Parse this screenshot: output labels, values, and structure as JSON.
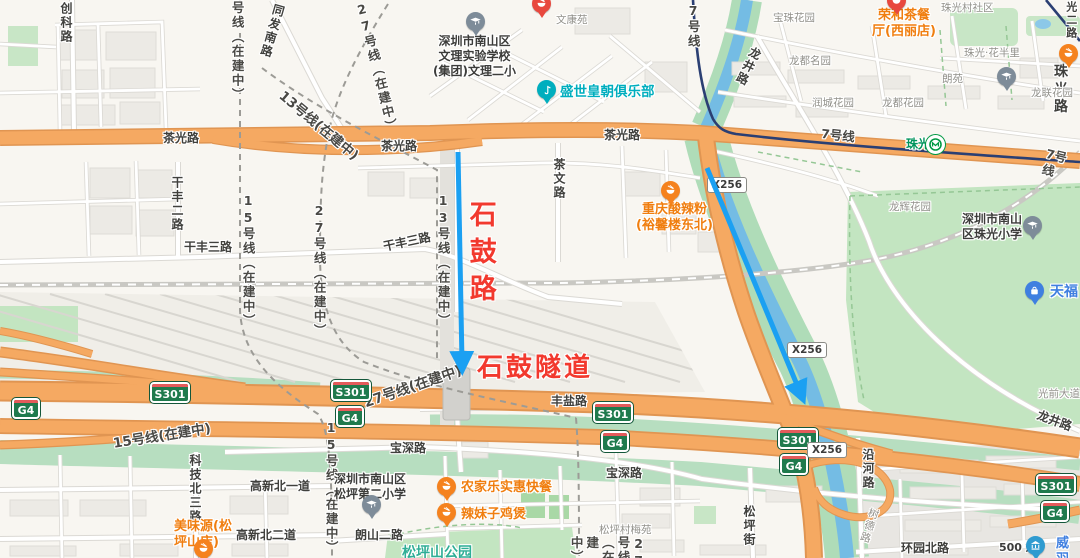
{
  "map": {
    "colors": {
      "background": "#F8F6F1",
      "orange_road": "#F5A962",
      "park_green": "#C3E5C1",
      "river_blue": "#74BCE4",
      "metro_navy": "#2B3F73",
      "badge_green": "#1F7A4D",
      "poi_orange": "#F07E0F",
      "annotation_red": "#F2392E",
      "arrow_blue": "#1BA0F2",
      "railway_gray": "#C9C8C3"
    },
    "scale_text": "500 米",
    "labels": [
      {
        "n": "road-chuangke-lu",
        "t": "创科路",
        "x": 58,
        "y": 2,
        "c": "rd",
        "v": 1,
        "i": false
      },
      {
        "n": "road-tongfa-nanlu",
        "t": "同发南路",
        "x": 272,
        "y": 2,
        "c": "rd",
        "v": 1,
        "r": 16,
        "i": false
      },
      {
        "n": "road-chaguang-lu-1",
        "t": "茶光路",
        "x": 163,
        "y": 131,
        "c": "rd",
        "i": false
      },
      {
        "n": "road-chaguang-lu-2",
        "t": "茶光路",
        "x": 381,
        "y": 139,
        "c": "rd",
        "i": false
      },
      {
        "n": "road-chaguang-lu-3",
        "t": "茶光路",
        "x": 604,
        "y": 128,
        "c": "rd",
        "i": false
      },
      {
        "n": "road-ganfeng-erlu",
        "t": "干丰二路",
        "x": 169,
        "y": 176,
        "c": "rd",
        "v": 1,
        "i": false
      },
      {
        "n": "road-ganfeng-sanlu-1",
        "t": "干丰三路",
        "x": 184,
        "y": 240,
        "c": "rd",
        "i": false
      },
      {
        "n": "road-ganfeng-sanlu-2",
        "t": "干丰三路",
        "x": 382,
        "y": 240,
        "c": "rd",
        "r": -12,
        "i": false
      },
      {
        "n": "road-chawen-lu",
        "t": "茶文路",
        "x": 551,
        "y": 158,
        "c": "rd",
        "v": 1,
        "i": false
      },
      {
        "n": "road-fengyan-lu",
        "t": "丰盐路",
        "x": 551,
        "y": 394,
        "c": "rd",
        "i": false
      },
      {
        "n": "road-baoshen-lu-1",
        "t": "宝深路",
        "x": 390,
        "y": 441,
        "c": "rd",
        "i": false
      },
      {
        "n": "road-baoshen-lu-2",
        "t": "宝深路",
        "x": 606,
        "y": 466,
        "c": "rd",
        "i": false
      },
      {
        "n": "road-gaoxin-beiyidao",
        "t": "高新北一道",
        "x": 250,
        "y": 479,
        "c": "rd",
        "i": false
      },
      {
        "n": "road-gaoxin-beierdao",
        "t": "高新北二道",
        "x": 236,
        "y": 528,
        "c": "rd",
        "i": false
      },
      {
        "n": "road-kejibei-sanlu",
        "t": "科技北三路",
        "x": 187,
        "y": 454,
        "c": "rd",
        "v": 1,
        "i": false
      },
      {
        "n": "road-langshan-erlu",
        "t": "朗山二路",
        "x": 355,
        "y": 528,
        "c": "rd",
        "i": false
      },
      {
        "n": "road-songping-jie",
        "t": "松坪街",
        "x": 741,
        "y": 505,
        "c": "rd",
        "v": 1,
        "i": false
      },
      {
        "n": "road-yanhe-lu",
        "t": "沿河路",
        "x": 860,
        "y": 448,
        "c": "rd",
        "v": 1,
        "i": false
      },
      {
        "n": "road-huanyuan-beilu",
        "t": "环园北路",
        "x": 901,
        "y": 541,
        "c": "rd",
        "i": false
      },
      {
        "n": "road-longjing-lu-1",
        "t": "龙井路",
        "x": 750,
        "y": 44,
        "c": "rd",
        "v": 1,
        "r": 26,
        "i": false
      },
      {
        "n": "road-longjing-lu-2",
        "t": "龙井路",
        "x": 1040,
        "y": 408,
        "c": "rd",
        "r": 20,
        "i": false
      },
      {
        "n": "road-zhuguang-lu",
        "t": "珠光路",
        "x": 1054,
        "y": 64,
        "c": "rd",
        "fs": 14,
        "i": false
      },
      {
        "n": "road-guang-er-lu",
        "t": "光二路",
        "x": 1064,
        "y": 1,
        "c": "rd",
        "v": 1,
        "fs": 11,
        "i": false
      },
      {
        "n": "road-guangqian-dadao",
        "t": "光前大道",
        "x": 1038,
        "y": 388,
        "c": "sm",
        "i": false
      },
      {
        "n": "road-shude-lu",
        "t": "树德路",
        "x": 868,
        "y": 506,
        "c": "sm",
        "v": 1,
        "r": 18,
        "i": false
      },
      {
        "n": "metro-15-top",
        "t": "号线（在建中）",
        "x": 229,
        "y": 1,
        "c": "met",
        "v": 1,
        "i": false
      },
      {
        "n": "metro-15-mid",
        "t": "15号线（在建中）",
        "x": 240,
        "y": 193,
        "c": "met",
        "v": 1,
        "i": false
      },
      {
        "n": "metro-27-mid",
        "t": "27号线（在建中）",
        "x": 311,
        "y": 203,
        "c": "met",
        "v": 1,
        "i": false
      },
      {
        "n": "metro-27-top",
        "t": "27号线（在建中）",
        "x": 352,
        "y": 4,
        "c": "met",
        "v": 1,
        "r": -14,
        "i": false
      },
      {
        "n": "metro-13-diag",
        "t": "13号线(在建中)",
        "x": 286,
        "y": 88,
        "c": "met",
        "r": 40,
        "fs": 13.5,
        "i": false
      },
      {
        "n": "metro-13-mid",
        "t": "13号线（在建中）",
        "x": 435,
        "y": 193,
        "c": "met",
        "v": 1,
        "i": false
      },
      {
        "n": "metro-15-diag",
        "t": "15号线(在建中)",
        "x": 112,
        "y": 436,
        "c": "met",
        "r": -9,
        "fs": 13.5,
        "i": false
      },
      {
        "n": "metro-15-low",
        "t": "15号线（在建中）",
        "x": 323,
        "y": 420,
        "c": "met",
        "v": 1,
        "i": false
      },
      {
        "n": "metro-27-diag",
        "t": "27号线(在建中)",
        "x": 362,
        "y": 396,
        "c": "met",
        "r": -19,
        "fs": 14,
        "i": false
      },
      {
        "n": "metro-27-low",
        "t": "27号线（在建中）",
        "x": 568,
        "y": 536,
        "c": "met",
        "v": 1,
        "i": false
      },
      {
        "n": "metro-7-top",
        "t": "7号线",
        "x": 685,
        "y": 3,
        "c": "met",
        "v": 1,
        "i": false
      },
      {
        "n": "metro-7-mid",
        "t": "7号线",
        "x": 822,
        "y": 126,
        "c": "met",
        "r": 6,
        "i": false
      },
      {
        "n": "metro-7-right",
        "t": "7号线",
        "x": 1048,
        "y": 146,
        "c": "met",
        "r": 14,
        "i": false
      },
      {
        "n": "estate-wenkangyuan",
        "t": "文康苑",
        "x": 556,
        "y": 14,
        "c": "sm",
        "i": false
      },
      {
        "n": "estate-baozhu-huayuan",
        "t": "宝珠花园",
        "x": 773,
        "y": 12,
        "c": "sm",
        "i": false
      },
      {
        "n": "estate-zhuguangcun-shequ",
        "t": "珠光村社区",
        "x": 941,
        "y": 2,
        "c": "sm",
        "i": false
      },
      {
        "n": "estate-zhuguang-huabanli",
        "t": "珠光·花半里",
        "x": 964,
        "y": 47,
        "c": "sm",
        "i": false
      },
      {
        "n": "estate-langyuan",
        "t": "朗苑",
        "x": 942,
        "y": 73,
        "c": "sm",
        "i": false
      },
      {
        "n": "estate-longdu-mingyuan",
        "t": "龙都名园",
        "x": 789,
        "y": 55,
        "c": "sm",
        "i": false
      },
      {
        "n": "estate-runcheng-huayuan",
        "t": "润城花园",
        "x": 812,
        "y": 97,
        "c": "sm",
        "i": false
      },
      {
        "n": "estate-longdu-huayuan",
        "t": "龙都花园",
        "x": 882,
        "y": 97,
        "c": "sm",
        "i": false
      },
      {
        "n": "estate-longlian-huayuan",
        "t": "龙联花园",
        "x": 1031,
        "y": 87,
        "c": "sm",
        "i": false
      },
      {
        "n": "estate-longhui-huayuan",
        "t": "龙辉花园",
        "x": 889,
        "y": 201,
        "c": "sm",
        "i": false
      },
      {
        "n": "estate-songpingcun-meiyuan",
        "t": "松坪村梅苑",
        "x": 599,
        "y": 524,
        "c": "sm",
        "i": false
      },
      {
        "n": "poi-ronghe-restaurant",
        "t": "荣和茶餐\n厅(西丽店)",
        "x": 872,
        "y": 8,
        "c": "org",
        "ctr": 1,
        "i": true
      },
      {
        "n": "poi-chongqing-suanlafen",
        "t": "重庆酸辣粉\n(裕馨楼东北)",
        "x": 636,
        "y": 202,
        "c": "org",
        "ctr": 1,
        "i": true
      },
      {
        "n": "poi-meiweiyuan",
        "t": "美味源(松\n坪山店)",
        "x": 174,
        "y": 519,
        "c": "org",
        "i": true
      },
      {
        "n": "poi-nongjiale",
        "t": "农家乐实惠快餐",
        "x": 461,
        "y": 480,
        "c": "org",
        "i": true
      },
      {
        "n": "poi-lameizi-jibao",
        "t": "辣妹子鸡煲",
        "x": 461,
        "y": 507,
        "c": "org",
        "i": true
      },
      {
        "n": "poi-shengshi-huangchao-club",
        "t": "盛世皇朝俱乐部",
        "x": 560,
        "y": 84,
        "c": "teal",
        "i": true
      },
      {
        "n": "poi-tianfu",
        "t": "天福",
        "x": 1050,
        "y": 284,
        "c": "blue",
        "fs": 14,
        "i": true
      },
      {
        "n": "poi-wei-clipped",
        "t": "威\n羽",
        "x": 1056,
        "y": 536,
        "c": "blue",
        "i": true
      },
      {
        "n": "metro-station-zhuguang",
        "t": "珠光",
        "x": 906,
        "y": 137,
        "c": "stn",
        "i": true
      },
      {
        "n": "park-songpingshan",
        "t": "松坪山公园",
        "x": 402,
        "y": 545,
        "c": "pk",
        "i": false
      },
      {
        "n": "school-wenli-exp",
        "t": "深圳市南山区\n文理实验学校\n(集团)文理二小",
        "x": 433,
        "y": 34,
        "c": "dk",
        "ctr": 1,
        "i": false
      },
      {
        "n": "school-zhuguang-primary",
        "t": "深圳市南山\n区珠光小学",
        "x": 962,
        "y": 212,
        "c": "dk",
        "ctr": 1,
        "i": false
      },
      {
        "n": "school-songping-no2",
        "t": "深圳市南山区\n松坪第二小学",
        "x": 334,
        "y": 472,
        "c": "dk",
        "ctr": 1,
        "i": false
      },
      {
        "n": "annotation-shigu-road",
        "t": "石鼓路",
        "x": 463,
        "y": 200,
        "c": "annv",
        "v": 1,
        "i": false
      },
      {
        "n": "annotation-shigu-tunnel",
        "t": "石鼓隧道",
        "x": 477,
        "y": 352,
        "c": "annh",
        "i": false
      },
      {
        "n": "scale-text",
        "t": "500 米",
        "x": 999,
        "y": 541,
        "c": "scale",
        "i": false
      }
    ],
    "badges": [
      {
        "k": "s301",
        "t": "S301",
        "x": 150,
        "y": 382
      },
      {
        "k": "s301",
        "t": "S301",
        "x": 331,
        "y": 380
      },
      {
        "k": "s301",
        "t": "S301",
        "x": 593,
        "y": 402
      },
      {
        "k": "s301",
        "t": "S301",
        "x": 778,
        "y": 428
      },
      {
        "k": "s301",
        "t": "S301",
        "x": 1036,
        "y": 474
      },
      {
        "k": "g4",
        "t": "G4",
        "x": 12,
        "y": 398
      },
      {
        "k": "g4",
        "t": "G4",
        "x": 336,
        "y": 406
      },
      {
        "k": "g4",
        "t": "G4",
        "x": 601,
        "y": 431
      },
      {
        "k": "g4",
        "t": "G4",
        "x": 780,
        "y": 454
      },
      {
        "k": "g4",
        "t": "G4",
        "x": 1041,
        "y": 501
      },
      {
        "k": "x256",
        "t": "X256",
        "x": 707,
        "y": 177
      },
      {
        "k": "x256",
        "t": "X256",
        "x": 787,
        "y": 342
      },
      {
        "k": "x256",
        "t": "X256",
        "x": 807,
        "y": 442
      }
    ],
    "pois": [
      {
        "n": "school-pin-wenli",
        "k": "cap",
        "x": 476,
        "y": 22
      },
      {
        "n": "school-pin-longlian",
        "k": "cap",
        "x": 1007,
        "y": 77
      },
      {
        "n": "school-pin-zhuguang",
        "k": "cap",
        "x": 1033,
        "y": 226
      },
      {
        "n": "school-pin-songping2",
        "k": "cap",
        "x": 372,
        "y": 505
      },
      {
        "n": "food-pin-chongqing",
        "k": "bowl",
        "x": 671,
        "y": 191
      },
      {
        "n": "food-pin-meiweiyuan",
        "k": "bowl",
        "x": 204,
        "y": 549
      },
      {
        "n": "food-pin-nongjiale",
        "k": "bowl",
        "x": 447,
        "y": 487
      },
      {
        "n": "food-pin-lameizi",
        "k": "bowl",
        "x": 447,
        "y": 513
      },
      {
        "n": "food-pin-zhuguang-east",
        "k": "bowl",
        "x": 1069,
        "y": 54
      },
      {
        "n": "food-pin-wenkangyuan",
        "k": "red",
        "x": 542,
        "y": 4
      },
      {
        "n": "food-pin-ronghe",
        "k": "red",
        "x": 897,
        "y": 1
      },
      {
        "n": "club-pin-shengshi",
        "k": "club",
        "x": 547,
        "y": 90
      },
      {
        "n": "shop-pin-tianfu",
        "k": "bag",
        "x": 1035,
        "y": 291
      },
      {
        "n": "bank-pin-wei",
        "k": "bank",
        "x": 1036,
        "y": 546
      },
      {
        "n": "metro-pin-zhuguang",
        "k": "metro",
        "x": 936,
        "y": 145
      }
    ],
    "arrows": [
      {
        "n": "annotation-arrow-shigu-road",
        "x1": 458,
        "y1": 152,
        "x2": 462,
        "y2": 362
      },
      {
        "n": "annotation-arrow-shahexi",
        "x1": 707,
        "y1": 168,
        "x2": 800,
        "y2": 392
      }
    ]
  }
}
